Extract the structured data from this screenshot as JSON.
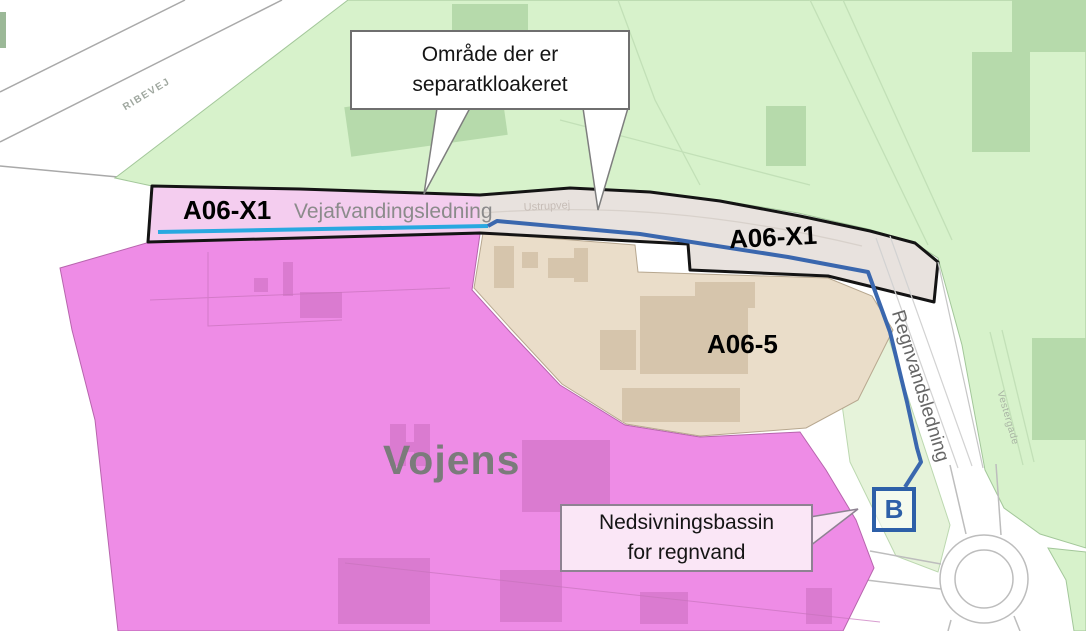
{
  "labels": {
    "ribevej": "RIBEVEJ",
    "a06x1_left": "A06-X1",
    "vejafvandingsledning": "Vejafvandingsledning",
    "ustrupvej": "Ustrupvej",
    "a06x1_right": "A06-X1",
    "a06_5": "A06-5",
    "vojens": "Vojens",
    "regnvandsledning": "Regnvandsledning",
    "vestergade": "Vestergade",
    "basin_marker": "B"
  },
  "callouts": {
    "separatkloakeret": {
      "line1": "Område der er",
      "line2": "separatkloakeret"
    },
    "nedsivningsbassin": {
      "line1": "Nedsivningsbassin",
      "line2": "for regnvand"
    }
  },
  "colors": {
    "green_area": "#d7f2cb",
    "green_building": "#b6daab",
    "magenta_area": "#ee8ce6",
    "magenta_building": "#da7bd0",
    "pink_band": "#f4cdef",
    "tan_area": "#eaddc9",
    "tan_building": "#d6c5ac",
    "road_band": "#e8e2de",
    "boundary": "#141414",
    "cyan_line": "#29a8e0",
    "blue_line": "#3a67ae",
    "marker_blue": "#2d5fa8"
  }
}
